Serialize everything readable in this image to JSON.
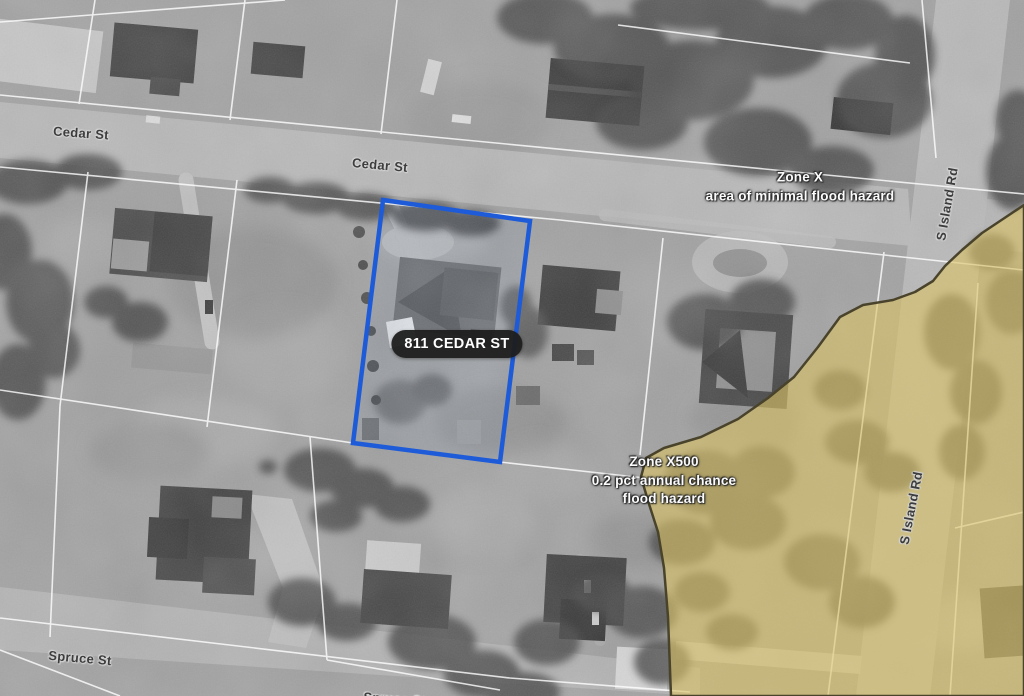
{
  "map": {
    "selected_parcel": {
      "address": "811 CEDAR ST",
      "outline_color": "#1e5bd8",
      "label_pill_bg": "#1e1e1e"
    },
    "streets": {
      "cedar_st_west": "Cedar St",
      "cedar_st_mid": "Cedar St",
      "spruce_st_west": "Spruce St",
      "spruce_st_mid": "Spruce St",
      "s_island_rd_north": "S Island Rd",
      "s_island_rd_south": "S Island Rd"
    },
    "flood_zones": {
      "zone_x": {
        "name": "Zone X",
        "description": "area of minimal flood hazard"
      },
      "zone_x500": {
        "name": "Zone X500",
        "description_line1": "0.2 pct annual chance",
        "description_line2": "flood hazard",
        "fill_color": "#d8c265",
        "border_color": "#49432b"
      }
    },
    "colors": {
      "parcel_line": "#ffffff",
      "road": "#b8b8b8",
      "ground": "#a2a2a2"
    }
  }
}
